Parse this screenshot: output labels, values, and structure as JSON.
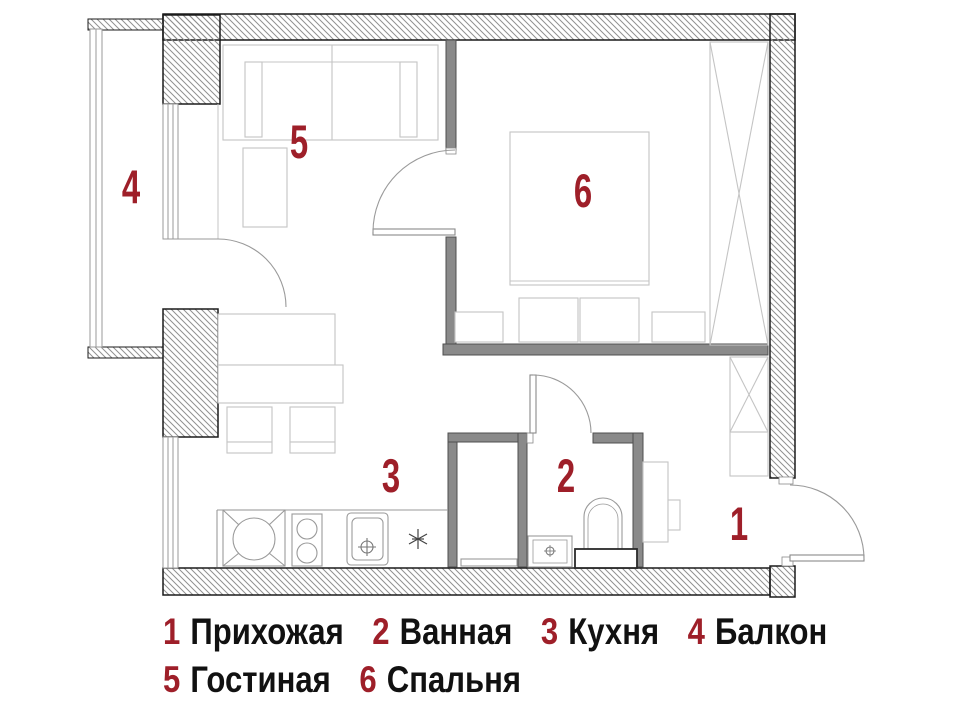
{
  "title": "Apartment floor plan with numbered rooms",
  "colors": {
    "background": "#ffffff",
    "label_red": "#9e1f29",
    "wall_gray": "#8a8a8a",
    "wall_outline": "#1b1b1b",
    "hatch_line": "#909090",
    "furniture_line": "#c4c4c4",
    "fixture_line": "#9a9a9a",
    "legend_black": "#111111"
  },
  "rooms": [
    {
      "num": "1",
      "name": "Прихожая"
    },
    {
      "num": "2",
      "name": "Ванная"
    },
    {
      "num": "3",
      "name": "Кухня"
    },
    {
      "num": "4",
      "name": "Балкон"
    },
    {
      "num": "5",
      "name": "Гостиная"
    },
    {
      "num": "6",
      "name": "Спальня"
    }
  ],
  "icons": {
    "washer": "washing-machine-icon",
    "stove": "stove-burners-icon",
    "kitchen_sink": "kitchen-sink-drain-icon",
    "star": "star-symbol-icon",
    "toilet": "toilet-icon",
    "bath_sink": "bathroom-sink-icon",
    "wardrobe": "wardrobe-crossed-icon",
    "doors": "door-swing-arc-icon",
    "windows": "window-glazing-icon"
  }
}
